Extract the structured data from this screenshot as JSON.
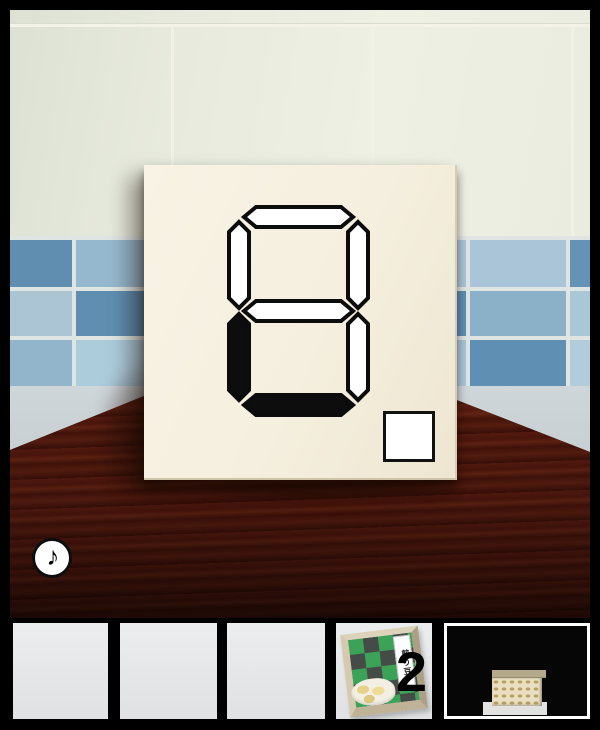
{
  "scene": {
    "description": "escape-game room: cream tiled wall with blue accent tile band, dark wooden table, white card showing a seven-segment display",
    "sound_button": {
      "icon": "music-note",
      "glyph": "♪"
    }
  },
  "display_card": {
    "type": "seven-segment display",
    "segments": {
      "A": "off",
      "B": "off",
      "C": "off",
      "D": "on",
      "E": "on",
      "F": "off",
      "G": "off"
    },
    "button": {
      "shape": "white-square"
    }
  },
  "colors": {
    "segment_on": "#0d0d0d",
    "segment_off": "#ffffff",
    "card": "#f5efdf",
    "table_wood": "#4c170d",
    "tile_blue_dark": "#5f8eb1",
    "tile_blue_light": "#a9c5d7",
    "slot_bg": "#e5e7e9"
  },
  "inventory": {
    "slots": [
      {
        "name": "slot-1",
        "state": "empty"
      },
      {
        "name": "slot-2",
        "state": "empty"
      },
      {
        "name": "slot-3",
        "state": "empty"
      },
      {
        "name": "slot-4",
        "state": "filled",
        "item": "roasted-bean-package",
        "label": "煎り豆",
        "count": "2"
      },
      {
        "name": "slot-5",
        "state": "selected-view",
        "item": "bean-box"
      }
    ]
  }
}
